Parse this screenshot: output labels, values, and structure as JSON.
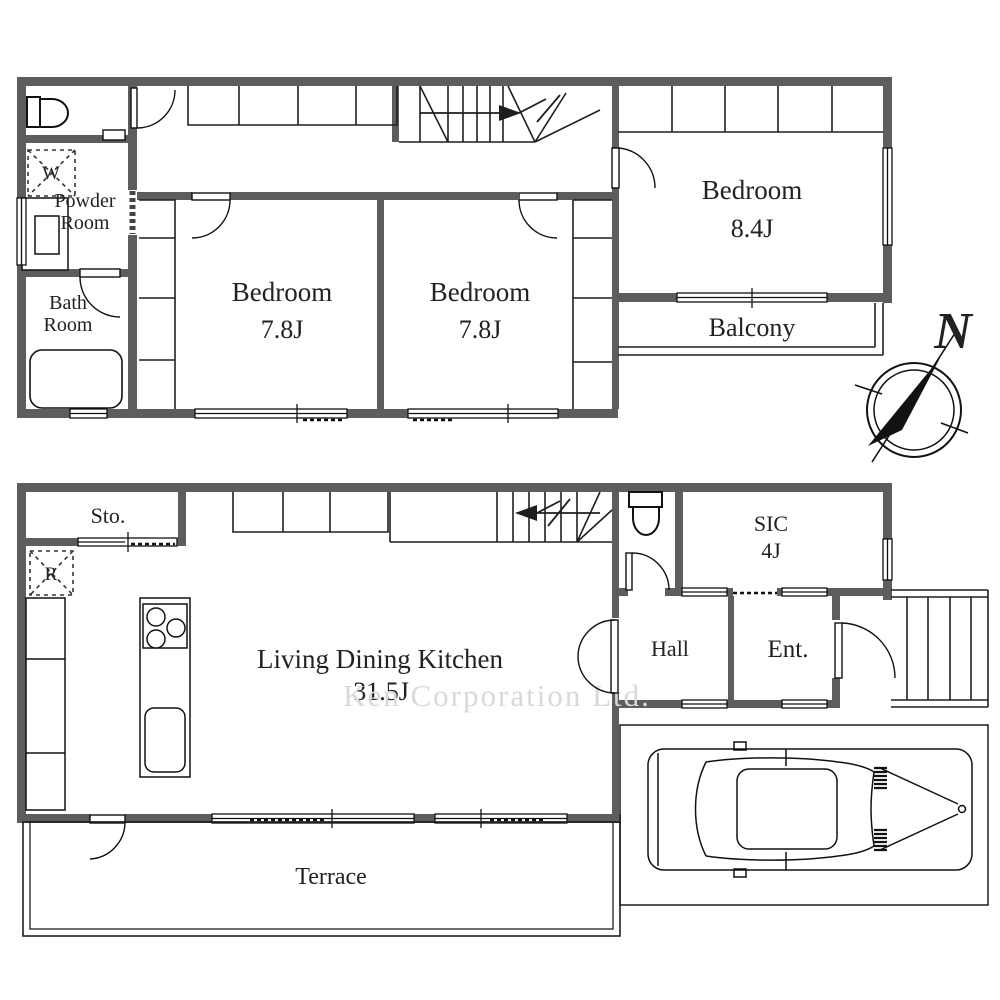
{
  "watermark": "Ken Corporation Ltd.",
  "compass": {
    "north": "N"
  },
  "floor2": {
    "powder_room": {
      "name_line1": "Powder",
      "name_line2": "Room"
    },
    "bath_room": {
      "name_line1": "Bath",
      "name_line2": "Room"
    },
    "washer": "W",
    "bedroom_left": {
      "name": "Bedroom",
      "size": "7.8J"
    },
    "bedroom_mid": {
      "name": "Bedroom",
      "size": "7.8J"
    },
    "bedroom_main": {
      "name": "Bedroom",
      "size": "8.4J"
    },
    "balcony": "Balcony"
  },
  "floor1": {
    "storage": "Sto.",
    "fridge": "R",
    "ldk": {
      "name": "Living Dining Kitchen",
      "size": "31.5J"
    },
    "sic": {
      "name": "SIC",
      "size": "4J"
    },
    "hall": "Hall",
    "entrance": "Ent.",
    "terrace": "Terrace"
  }
}
